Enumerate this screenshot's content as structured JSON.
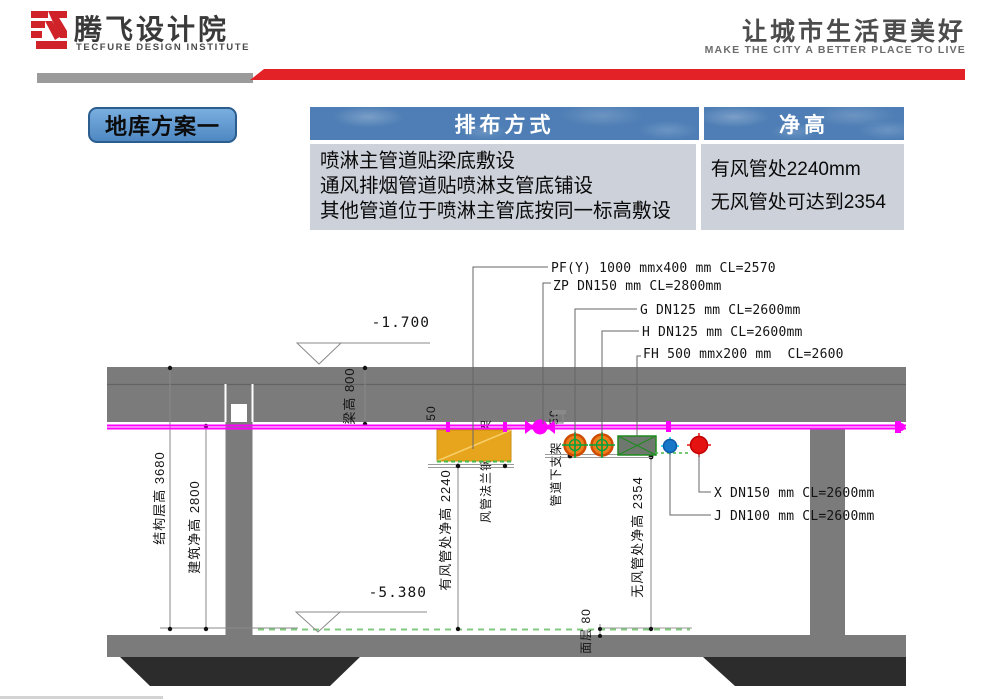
{
  "header": {
    "logo_title": "腾飞设计院",
    "logo_subtitle": "TECFURE DESIGN INSTITUTE",
    "slogan": "让城市生活更美好",
    "slogan_en": "MAKE THE CITY A BETTER PLACE TO LIVE"
  },
  "scheme_label": "地库方案一",
  "table": {
    "headers": {
      "arrangement": "排布方式",
      "clear_height": "净高"
    },
    "arrangement_lines": [
      "喷淋主管道贴梁底敷设",
      "通风排烟管道贴喷淋支管底铺设",
      "其他管道位于喷淋主管底按同一标高敷设"
    ],
    "clear_height_lines": [
      "有风管处2240mm",
      "无风管处可达到2354"
    ]
  },
  "drawing": {
    "pipe_labels": [
      {
        "id": "PF(Y)",
        "text": "PF(Y) 1000 mmx400 mm CL=2570"
      },
      {
        "id": "ZP",
        "text": "ZP DN150 mm CL=2800mm"
      },
      {
        "id": "G",
        "text": "G DN125 mm CL=2600mm"
      },
      {
        "id": "H",
        "text": "H DN125 mm CL=2600mm"
      },
      {
        "id": "FH",
        "text": "FH 500 mmx200 mm  CL=2600"
      },
      {
        "id": "X",
        "text": "X DN150 mm CL=2600mm"
      },
      {
        "id": "J",
        "text": "J DN100 mm CL=2600mm"
      }
    ],
    "elevations": {
      "ceiling": "-1.700",
      "floor": "-5.380"
    },
    "dimensions": {
      "structural_height": "结构层高 3680",
      "building_clear_height": "建筑净高 2800",
      "beam_height": "梁高 800",
      "with_duct_clear": "有风管处净高 2240",
      "no_duct_clear": "无风管处净高 2354",
      "finish_layer": "面层 80",
      "duct_flange_support": "风管法兰钢及支架",
      "pipe_under_support": "管道下支架",
      "gap_left": "50",
      "gap_right": "50"
    },
    "colors": {
      "accent_red": "#e32227",
      "table_header_blue": "#4e7eb5",
      "table_body_gray": "#cdd1da",
      "scheme_label_blue": "#5b9bd5",
      "sprinkler_magenta": "#ff00ff",
      "duct_yellow": "#e7a51e",
      "pipe_orange": "#ee7d1c",
      "pipe_red": "#e51212",
      "pipe_blue": "#1878c8",
      "symbol_green": "#00a33c",
      "concrete_gray": "#7b7b7b",
      "pile_cap_dark": "#2c2c2c"
    }
  }
}
